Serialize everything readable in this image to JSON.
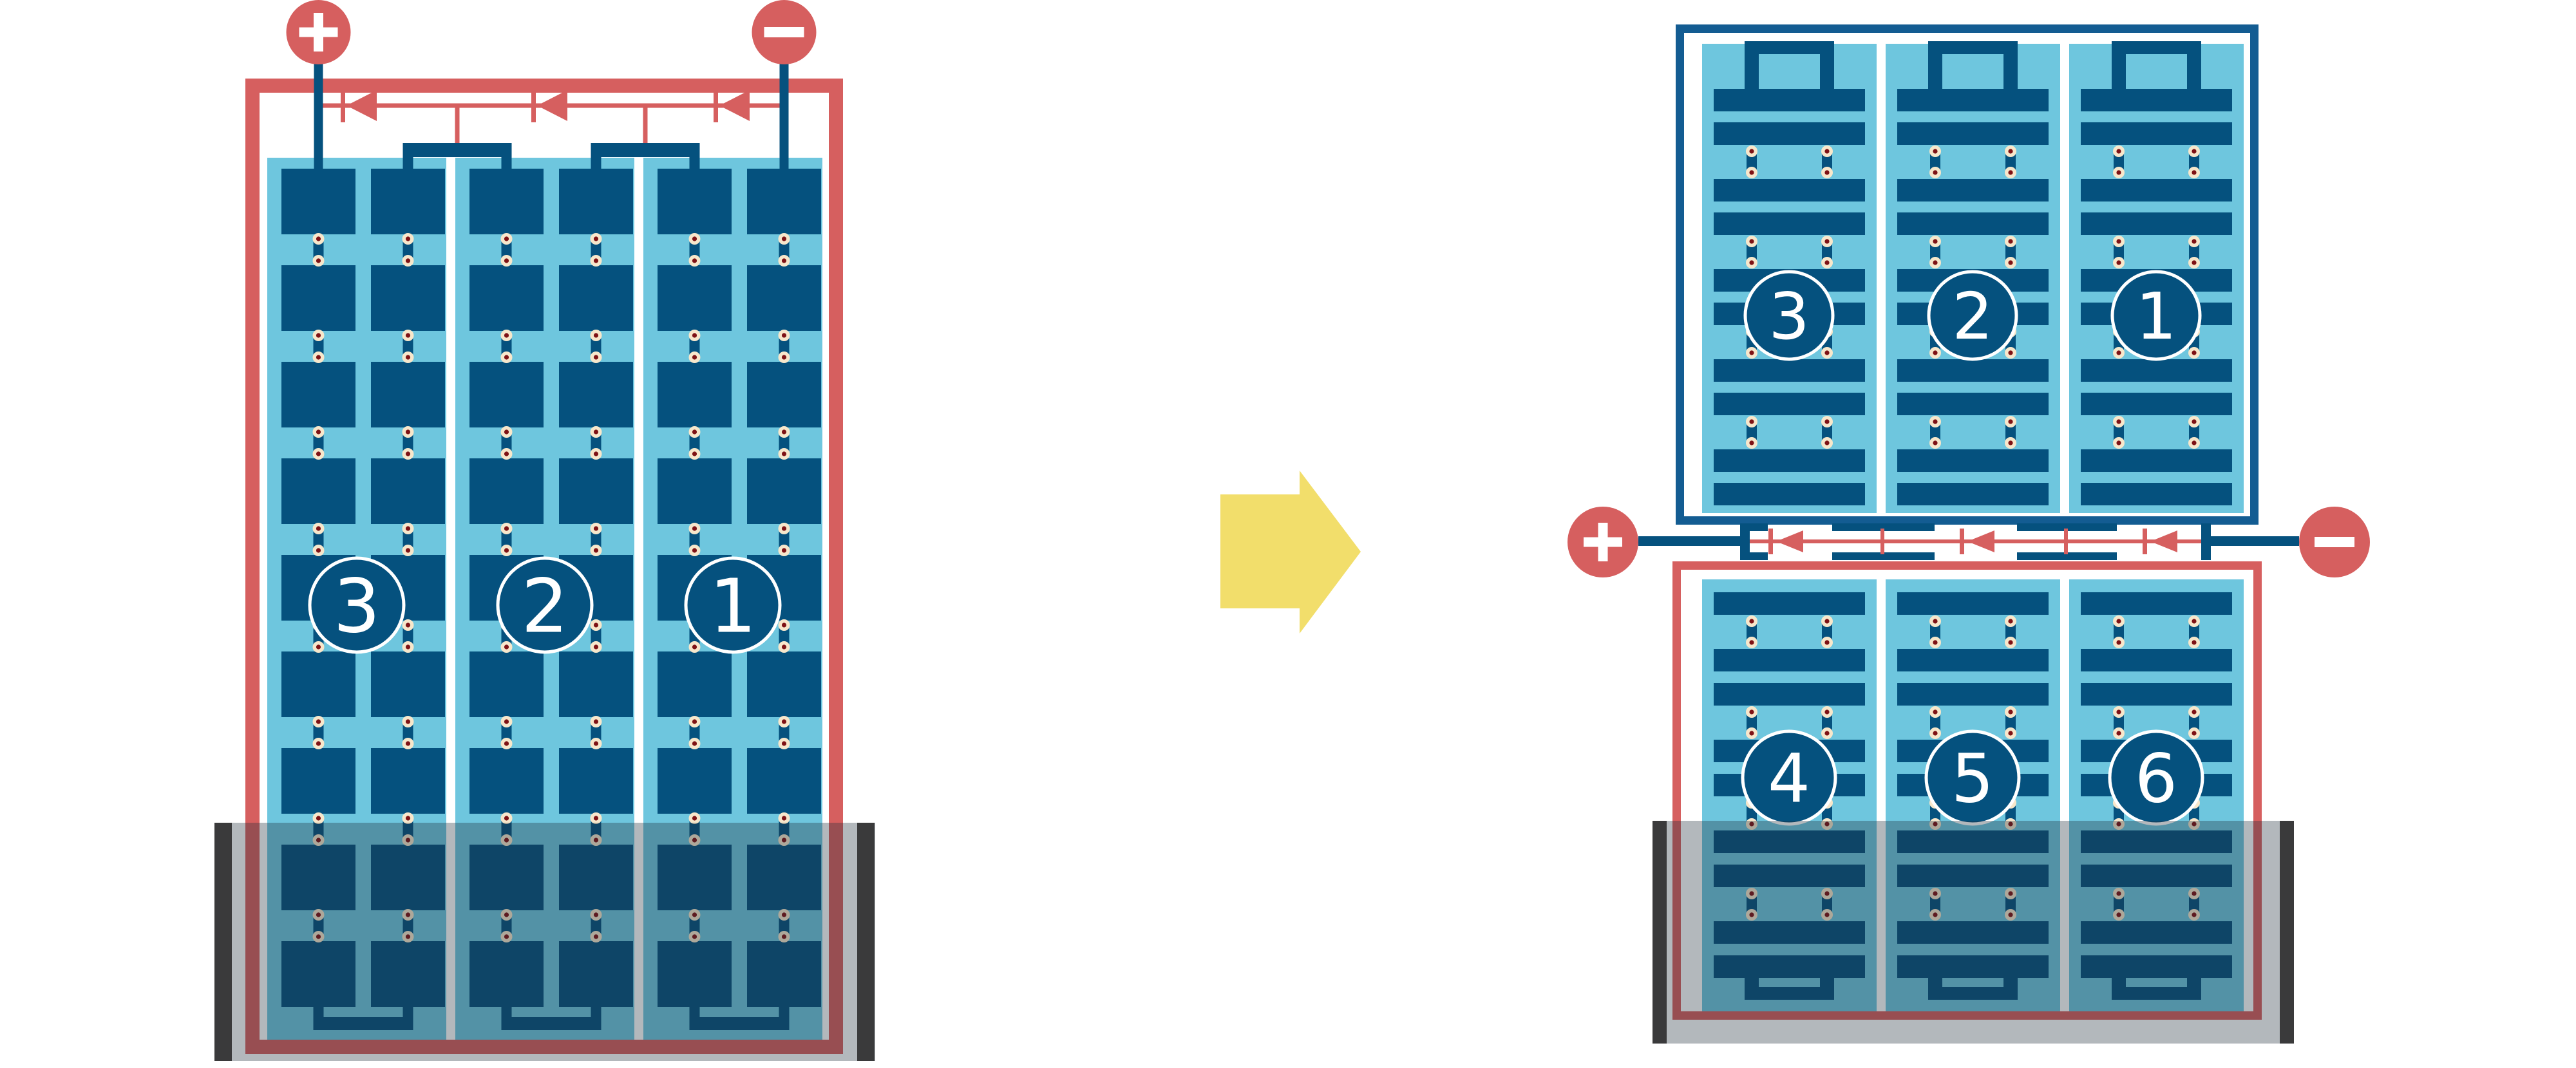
{
  "figure": {
    "description_visible_text_only": true,
    "arrow": {
      "direction": "right"
    }
  },
  "colors": {
    "background": "#FFFFFF",
    "accent_red": "#D65F5F",
    "cell_blue": "#05517E",
    "frame_blue": "#135C92",
    "panel_light_blue": "#6EC6DE",
    "solder_ring_cream": "#F7E7CB",
    "solder_core_maroon": "#7E1215",
    "shade_edge_bar": "#3A3A3B",
    "shade_overlay": "rgba(33,47,58,0.34)",
    "arrow_yellow": "#F2DE6B",
    "label_white": "#FFFFFF"
  },
  "left_module": {
    "terminals": {
      "positive_symbol": "+",
      "negative_symbol": "−"
    },
    "bypass_diodes": 3,
    "cell_rows": 9,
    "sub_columns_per_string": 2,
    "strings": [
      {
        "label": "3"
      },
      {
        "label": "2"
      },
      {
        "label": "1"
      }
    ],
    "shading": {
      "position": "bottom",
      "edge_bars": 2
    }
  },
  "right_module": {
    "terminals": {
      "positive_symbol": "+",
      "negative_symbol": "−"
    },
    "bypass_diodes": 3,
    "top_half": {
      "half_cell_rows": 10,
      "strings": [
        {
          "label": "3"
        },
        {
          "label": "2"
        },
        {
          "label": "1"
        }
      ],
      "shaded": false
    },
    "bottom_half": {
      "half_cell_rows": 9,
      "strings": [
        {
          "label": "4"
        },
        {
          "label": "5"
        },
        {
          "label": "6"
        }
      ],
      "shaded": true
    }
  }
}
